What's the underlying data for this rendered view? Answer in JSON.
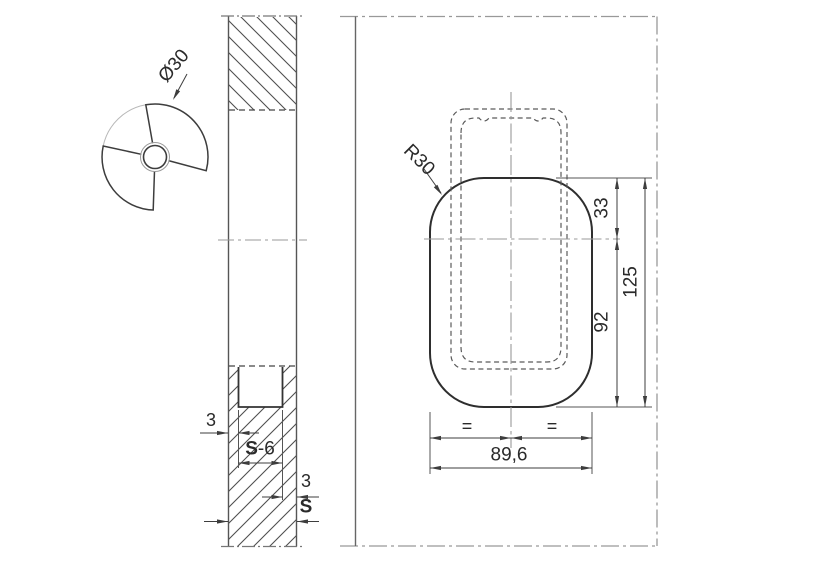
{
  "drawing": {
    "detail_view": {
      "diameter_label": "Ø30"
    },
    "main_view": {
      "radius_label": "R30",
      "dim_top_to_center": "33",
      "dim_center_to_bottom": "92",
      "dim_height": "125",
      "dim_width": "89,6",
      "equal_left": "=",
      "equal_right": "="
    },
    "section_view": {
      "wall_left": "3",
      "slot_s": "S",
      "slot_suffix": "-6",
      "wall_right": "3",
      "thickness": "S"
    }
  },
  "colors": {
    "line": "#3d3d3d",
    "bold_line": "#2e2e2e",
    "phantom_line": "#999999",
    "hatch_line": "#4f4f4f",
    "background": "#ffffff"
  }
}
